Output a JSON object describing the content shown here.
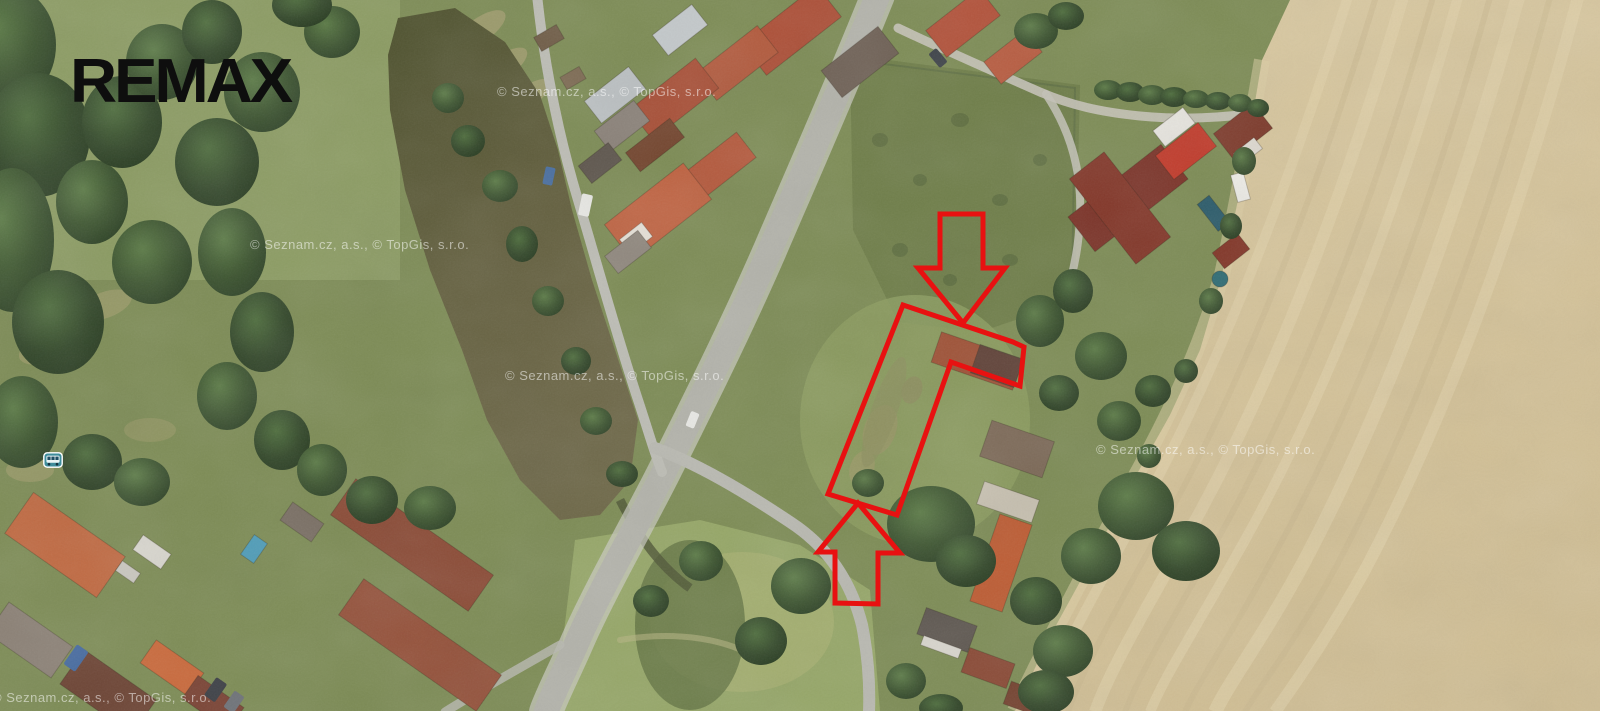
{
  "page": {
    "type": "aerial-photo-listing",
    "width": 1600,
    "height": 711
  },
  "branding": {
    "logo_text": "REMAX",
    "logo_color": "#0e0e0e"
  },
  "map": {
    "provider_watermark": {
      "text": "© Seznam.cz, a.s., © TopGis, s.r.o.",
      "color": "rgba(255,255,255,0.52)",
      "instances": [
        {
          "x": 250,
          "y": 249
        },
        {
          "x": 497,
          "y": 96
        },
        {
          "x": 505,
          "y": 380
        },
        {
          "x": 1096,
          "y": 454
        },
        {
          "x": -8,
          "y": 702
        }
      ]
    },
    "poi": {
      "bus_stop": {
        "x": 43,
        "y": 452,
        "width": 20,
        "height": 16
      }
    }
  },
  "annotations": {
    "color": "#e81111",
    "stroke_width": 5,
    "parcel_outline": {
      "points": "903,305 1013,342 1024,347 1020,386 951,362 897,515 828,494"
    },
    "arrow_top": {
      "direction": "down",
      "points": "940,214 983,214 983,268 1005,268 963,323 918,268 940,268"
    },
    "arrow_bottom": {
      "direction": "up",
      "points": "858,503 900,553 878,553 878,604 835,603 835,552 818,552"
    }
  },
  "palette": {
    "grass": "#7d8c55",
    "grass_light": "#8e9d65",
    "tree": "#3c5430",
    "pond": "#5e5c3a",
    "field_tan": "#d6c59d",
    "road": "#b3b3ab",
    "roof_red": "#b2523a",
    "roof_dark_red": "#7c3429",
    "accent_red": "#e81111"
  }
}
